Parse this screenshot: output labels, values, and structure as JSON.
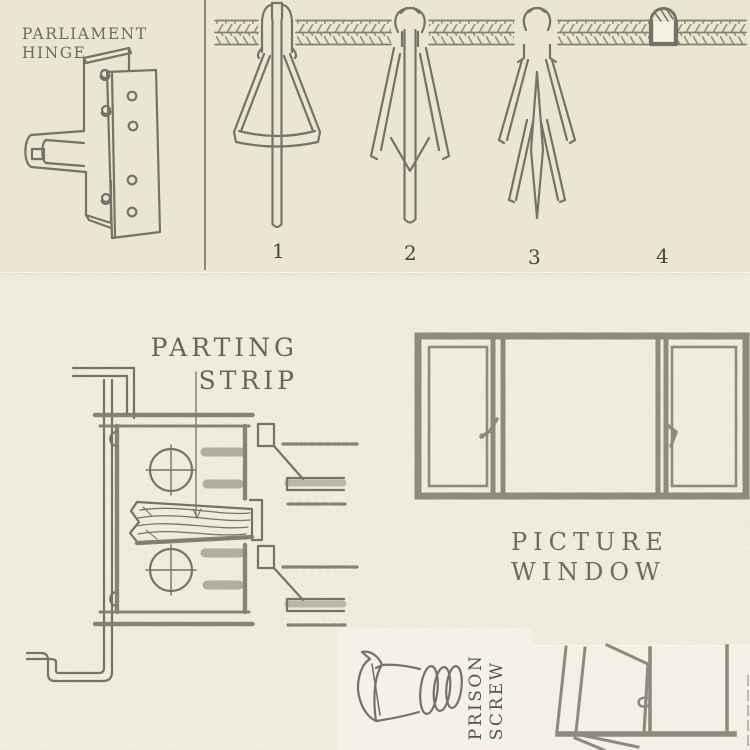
{
  "page": {
    "background_color": "#f0ecdd",
    "top_section_background": "#ebe6d1",
    "ink_color": "#76726a",
    "label_color": "#6b675c"
  },
  "figures": {
    "parliament_hinge": {
      "label_line1": "PARLIAMENT",
      "label_line2": "HINGE"
    },
    "anchor_sequence": {
      "item_numbers": [
        "1",
        "2",
        "3",
        "4"
      ]
    },
    "parting_strip": {
      "label_line1": "PARTING",
      "label_line2": "STRIP"
    },
    "picture_window": {
      "label_line1": "PICTURE",
      "label_line2": "WINDOW"
    },
    "prison_screw": {
      "label_line1": "PRISON",
      "label_line2": "SCREW"
    }
  }
}
